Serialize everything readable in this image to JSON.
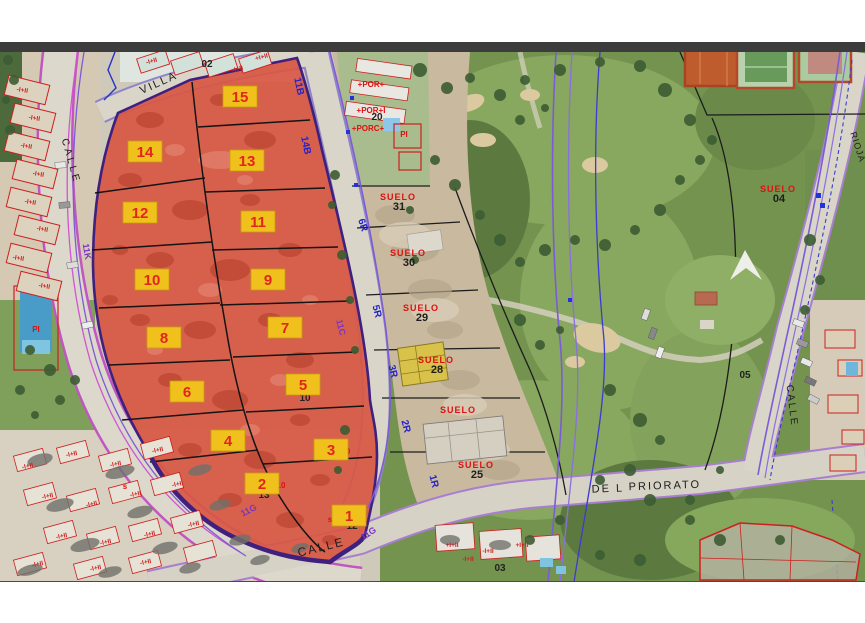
{
  "colors": {
    "highlight_red": "#d85743",
    "highlight_red_dark": "#a8331f",
    "zone_border_purple": "#40207e",
    "tag_yellow": "#f0c11c",
    "tag_border": "#c79e08",
    "tag_number_red": "#e2251d",
    "suelo_red": "#dd1111",
    "code_blue": "#2323cc",
    "code_purple": "#7a35c0",
    "cadastral_red": "#cc2020",
    "road_fill": "#d9d5c9",
    "golf_green": "#74934f",
    "top_bar": "#3c3c3c"
  },
  "map": {
    "parcel_tags": [
      {
        "n": "15",
        "x": 240,
        "y": 97
      },
      {
        "n": "14",
        "x": 145,
        "y": 152
      },
      {
        "n": "13",
        "x": 247,
        "y": 161
      },
      {
        "n": "12",
        "x": 140,
        "y": 213
      },
      {
        "n": "11",
        "x": 258,
        "y": 222
      },
      {
        "n": "10",
        "x": 152,
        "y": 280
      },
      {
        "n": "9",
        "x": 268,
        "y": 280
      },
      {
        "n": "8",
        "x": 164,
        "y": 338
      },
      {
        "n": "7",
        "x": 285,
        "y": 328
      },
      {
        "n": "6",
        "x": 187,
        "y": 392
      },
      {
        "n": "5",
        "x": 303,
        "y": 385
      },
      {
        "n": "4",
        "x": 228,
        "y": 441
      },
      {
        "n": "3",
        "x": 331,
        "y": 450
      },
      {
        "n": "2",
        "x": 262,
        "y": 484
      },
      {
        "n": "1",
        "x": 349,
        "y": 516
      }
    ],
    "suelo_labels": [
      {
        "title": "SUELO",
        "num": "31",
        "x": 398,
        "y": 200
      },
      {
        "title": "SUELO",
        "num": "30",
        "x": 408,
        "y": 256
      },
      {
        "title": "SUELO",
        "num": "29",
        "x": 421,
        "y": 311
      },
      {
        "title": "SUELO",
        "num": "28",
        "x": 436,
        "y": 363
      },
      {
        "title": "SUELO",
        "num": "",
        "x": 458,
        "y": 413
      },
      {
        "title": "SUELO",
        "num": "25",
        "x": 476,
        "y": 468
      },
      {
        "title": "SUELO",
        "num": "04",
        "x": 778,
        "y": 192
      }
    ],
    "black_labels": [
      {
        "t": "02",
        "x": 207,
        "y": 67
      },
      {
        "t": "20",
        "x": 377,
        "y": 120
      },
      {
        "t": "05",
        "x": 745,
        "y": 378
      },
      {
        "t": "03",
        "x": 500,
        "y": 571
      },
      {
        "t": "12",
        "x": 352,
        "y": 529
      },
      {
        "t": "13",
        "x": 264,
        "y": 498
      },
      {
        "t": "10",
        "x": 305,
        "y": 401
      }
    ],
    "red_labels": [
      {
        "t": "+POR+",
        "x": 371,
        "y": 87
      },
      {
        "t": "+POR+I",
        "x": 371,
        "y": 113
      },
      {
        "t": "+PORC+",
        "x": 368,
        "y": 131
      },
      {
        "t": "PI",
        "x": 404,
        "y": 137
      },
      {
        "t": "PI",
        "x": 36,
        "y": 332
      },
      {
        "t": "10",
        "x": 281,
        "y": 488
      },
      {
        "t": "0",
        "x": 348,
        "y": 454
      },
      {
        "t": "s",
        "x": 330,
        "y": 522
      },
      {
        "t": "s",
        "x": 215,
        "y": 445
      },
      {
        "t": "s",
        "x": 125,
        "y": 489
      }
    ],
    "street_names": [
      {
        "t": "VILLA",
        "x": 160,
        "y": 86,
        "rot": -24,
        "size": 11,
        "ls": 2
      },
      {
        "t": "CALLE",
        "x": 68,
        "y": 162,
        "rot": 74,
        "size": 10,
        "ls": 3
      },
      {
        "t": "CALLE",
        "x": 322,
        "y": 551,
        "rot": -14,
        "size": 12,
        "ls": 2
      },
      {
        "t": "DE L",
        "x": 608,
        "y": 492,
        "rot": -2,
        "size": 11,
        "ls": 2
      },
      {
        "t": "PRIORATO",
        "x": 665,
        "y": 489,
        "rot": -2,
        "size": 11,
        "ls": 2
      },
      {
        "t": "CALLE",
        "x": 789,
        "y": 406,
        "rot": 83,
        "size": 10,
        "ls": 2
      },
      {
        "t": "RIOJA",
        "x": 855,
        "y": 148,
        "rot": 72,
        "size": 9,
        "ls": 1
      }
    ],
    "blue_codes": [
      {
        "t": "6R",
        "x": 360,
        "y": 226,
        "rot": 72
      },
      {
        "t": "5R",
        "x": 374,
        "y": 312,
        "rot": 75
      },
      {
        "t": "3R",
        "x": 390,
        "y": 372,
        "rot": 75
      },
      {
        "t": "2R",
        "x": 403,
        "y": 427,
        "rot": 75
      },
      {
        "t": "1R",
        "x": 431,
        "y": 482,
        "rot": 75
      },
      {
        "t": "11B",
        "x": 296,
        "y": 87,
        "rot": 78
      },
      {
        "t": "14B",
        "x": 303,
        "y": 146,
        "rot": 78
      }
    ],
    "purple_codes": [
      {
        "t": "11K",
        "x": 84,
        "y": 252,
        "rot": 80
      },
      {
        "t": "11C",
        "x": 338,
        "y": 328,
        "rot": 76
      },
      {
        "t": "11G",
        "x": 250,
        "y": 513,
        "rot": -27
      },
      {
        "t": "11G",
        "x": 370,
        "y": 536,
        "rot": -33
      }
    ],
    "cadastral_marks": [
      {
        "t": "-I+II",
        "x": 22,
        "y": 92,
        "rot": 10
      },
      {
        "t": "-I+II",
        "x": 34,
        "y": 120,
        "rot": 10
      },
      {
        "t": "-I+II",
        "x": 26,
        "y": 148,
        "rot": 10
      },
      {
        "t": "-I+II",
        "x": 38,
        "y": 176,
        "rot": 10
      },
      {
        "t": "-I+II",
        "x": 30,
        "y": 204,
        "rot": 10
      },
      {
        "t": "-I+II",
        "x": 42,
        "y": 231,
        "rot": 10
      },
      {
        "t": "-I+II",
        "x": 18,
        "y": 260,
        "rot": 10
      },
      {
        "t": "-I+II",
        "x": 44,
        "y": 288,
        "rot": 10
      },
      {
        "t": "-I+II",
        "x": 152,
        "y": 63,
        "rot": -15
      },
      {
        "t": "-I+II",
        "x": 238,
        "y": 71,
        "rot": -15
      },
      {
        "t": "+I+II",
        "x": 262,
        "y": 59,
        "rot": -15
      },
      {
        "t": "-I+II",
        "x": 28,
        "y": 468,
        "rot": -12
      },
      {
        "t": "-I+II",
        "x": 72,
        "y": 456,
        "rot": -12
      },
      {
        "t": "-I+II",
        "x": 116,
        "y": 466,
        "rot": -12
      },
      {
        "t": "-I+II",
        "x": 158,
        "y": 452,
        "rot": -12
      },
      {
        "t": "-I+II",
        "x": 48,
        "y": 498,
        "rot": -12
      },
      {
        "t": "-I+II",
        "x": 92,
        "y": 506,
        "rot": -12
      },
      {
        "t": "-I+II",
        "x": 136,
        "y": 496,
        "rot": -12
      },
      {
        "t": "-I+II",
        "x": 178,
        "y": 486,
        "rot": -12
      },
      {
        "t": "-I+II",
        "x": 62,
        "y": 538,
        "rot": -12
      },
      {
        "t": "-I+II",
        "x": 106,
        "y": 544,
        "rot": -12
      },
      {
        "t": "-I+II",
        "x": 150,
        "y": 536,
        "rot": -12
      },
      {
        "t": "-I+II",
        "x": 194,
        "y": 526,
        "rot": -12
      },
      {
        "t": "-I+II",
        "x": 38,
        "y": 566,
        "rot": -12
      },
      {
        "t": "-I+II",
        "x": 96,
        "y": 570,
        "rot": -12
      },
      {
        "t": "-I+II",
        "x": 146,
        "y": 564,
        "rot": -12
      },
      {
        "t": "+I+II",
        "x": 452,
        "y": 547,
        "rot": 0
      },
      {
        "t": "-I+II",
        "x": 488,
        "y": 553,
        "rot": 0
      },
      {
        "t": "+I+II",
        "x": 522,
        "y": 547,
        "rot": 0
      },
      {
        "t": "-I+II",
        "x": 468,
        "y": 561,
        "rot": 0
      }
    ]
  }
}
